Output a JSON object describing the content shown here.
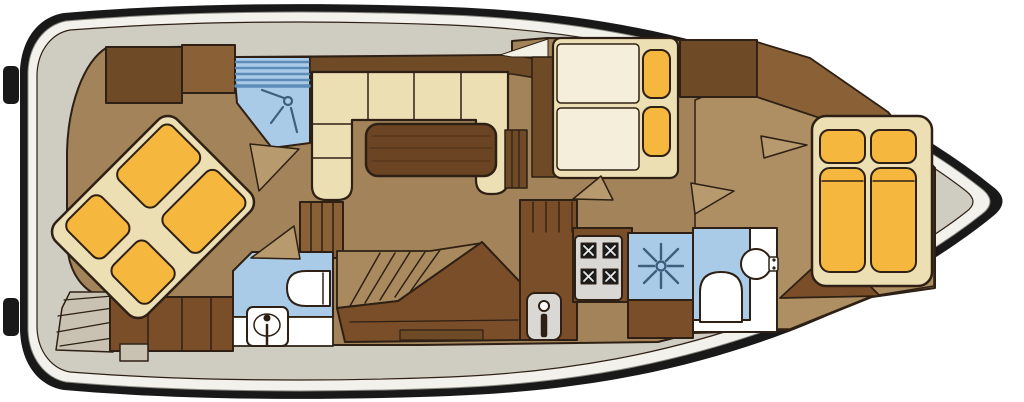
{
  "figure": {
    "kind": "boat-interior-floor-plan",
    "view": "top-down deck plan"
  },
  "rooms": [
    "fore-cabin-island-berth",
    "fore-shower",
    "fore-bathroom",
    "salon-dinette-with-table",
    "companionway-stairs",
    "midship-twin-berths",
    "galley",
    "mid-shower",
    "aft-bathroom",
    "aft-cabin-double-berth"
  ],
  "icons": [
    "shower-head-icon",
    "shower-spray-icon",
    "toilet-icon",
    "washbasin-icon",
    "faucet-icon",
    "stove-burners-icon"
  ],
  "colors": {
    "background": "#ffffff",
    "hull": "#191919",
    "band": "#f2f1ec",
    "band_edge": "#8a8a82",
    "deck": "#cfccc2",
    "outline": "#2e2014",
    "floor": "#a3845a",
    "floor_aft": "#ad8f63",
    "wood_dark": "#7a4e28",
    "wood_med": "#8a6136",
    "cabinet": "#6e4a26",
    "cream": "#ecdfb4",
    "mattress": "#f4eedb",
    "yellow": "#f6b73e",
    "blue": "#a9cbe8",
    "blue_line": "#5d8cb8",
    "white": "#ffffff",
    "appliance": "#d9d8d4",
    "burner": "#1c1c1c",
    "burner_line": "#e9e9e9",
    "table": "#6b4423",
    "table_line": "#57351a",
    "stairs": "#a98a5e",
    "steps_deck": "#c9c2b2",
    "door": "#b79a6e",
    "sliver": "#f4f1e6",
    "icon_blue": "#3f5e7e"
  }
}
